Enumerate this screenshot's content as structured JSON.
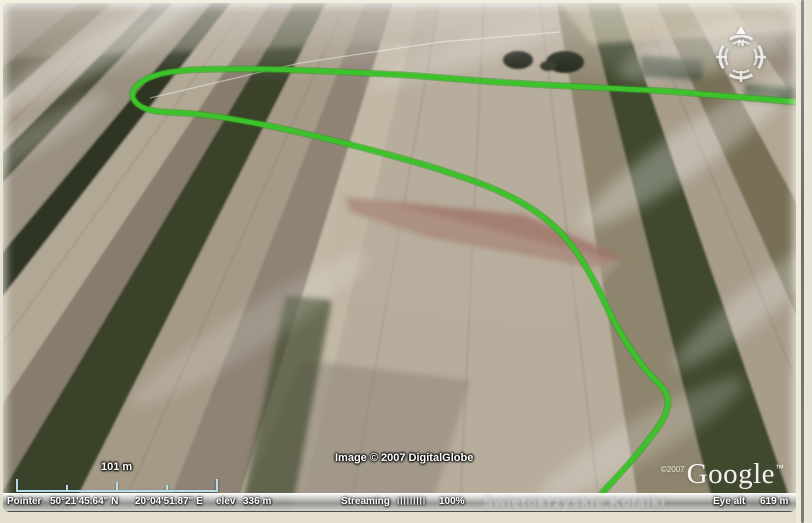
{
  "map": {
    "compass": {
      "north_label": "N"
    },
    "scale_bar": {
      "label": "101 m"
    },
    "attribution": "Image © 2007 DigitalGlobe",
    "watermark": "Świętokrzyskie Kołaiki",
    "logo": {
      "copyright": "©2007",
      "brand": "Google",
      "trademark": "™"
    },
    "track_color": "#3cc32c"
  },
  "status_bar": {
    "pointer_label": "Pointer",
    "latitude": "50°21'45.64\" N",
    "longitude": "20°04'51.87\" E",
    "elevation_label": "elev",
    "elevation_value": "336 m",
    "streaming_label": "Streaming",
    "streaming_bars": "|||||||||",
    "streaming_percent": "100%",
    "eye_alt_label": "Eye alt",
    "eye_alt_value": "619 m"
  }
}
